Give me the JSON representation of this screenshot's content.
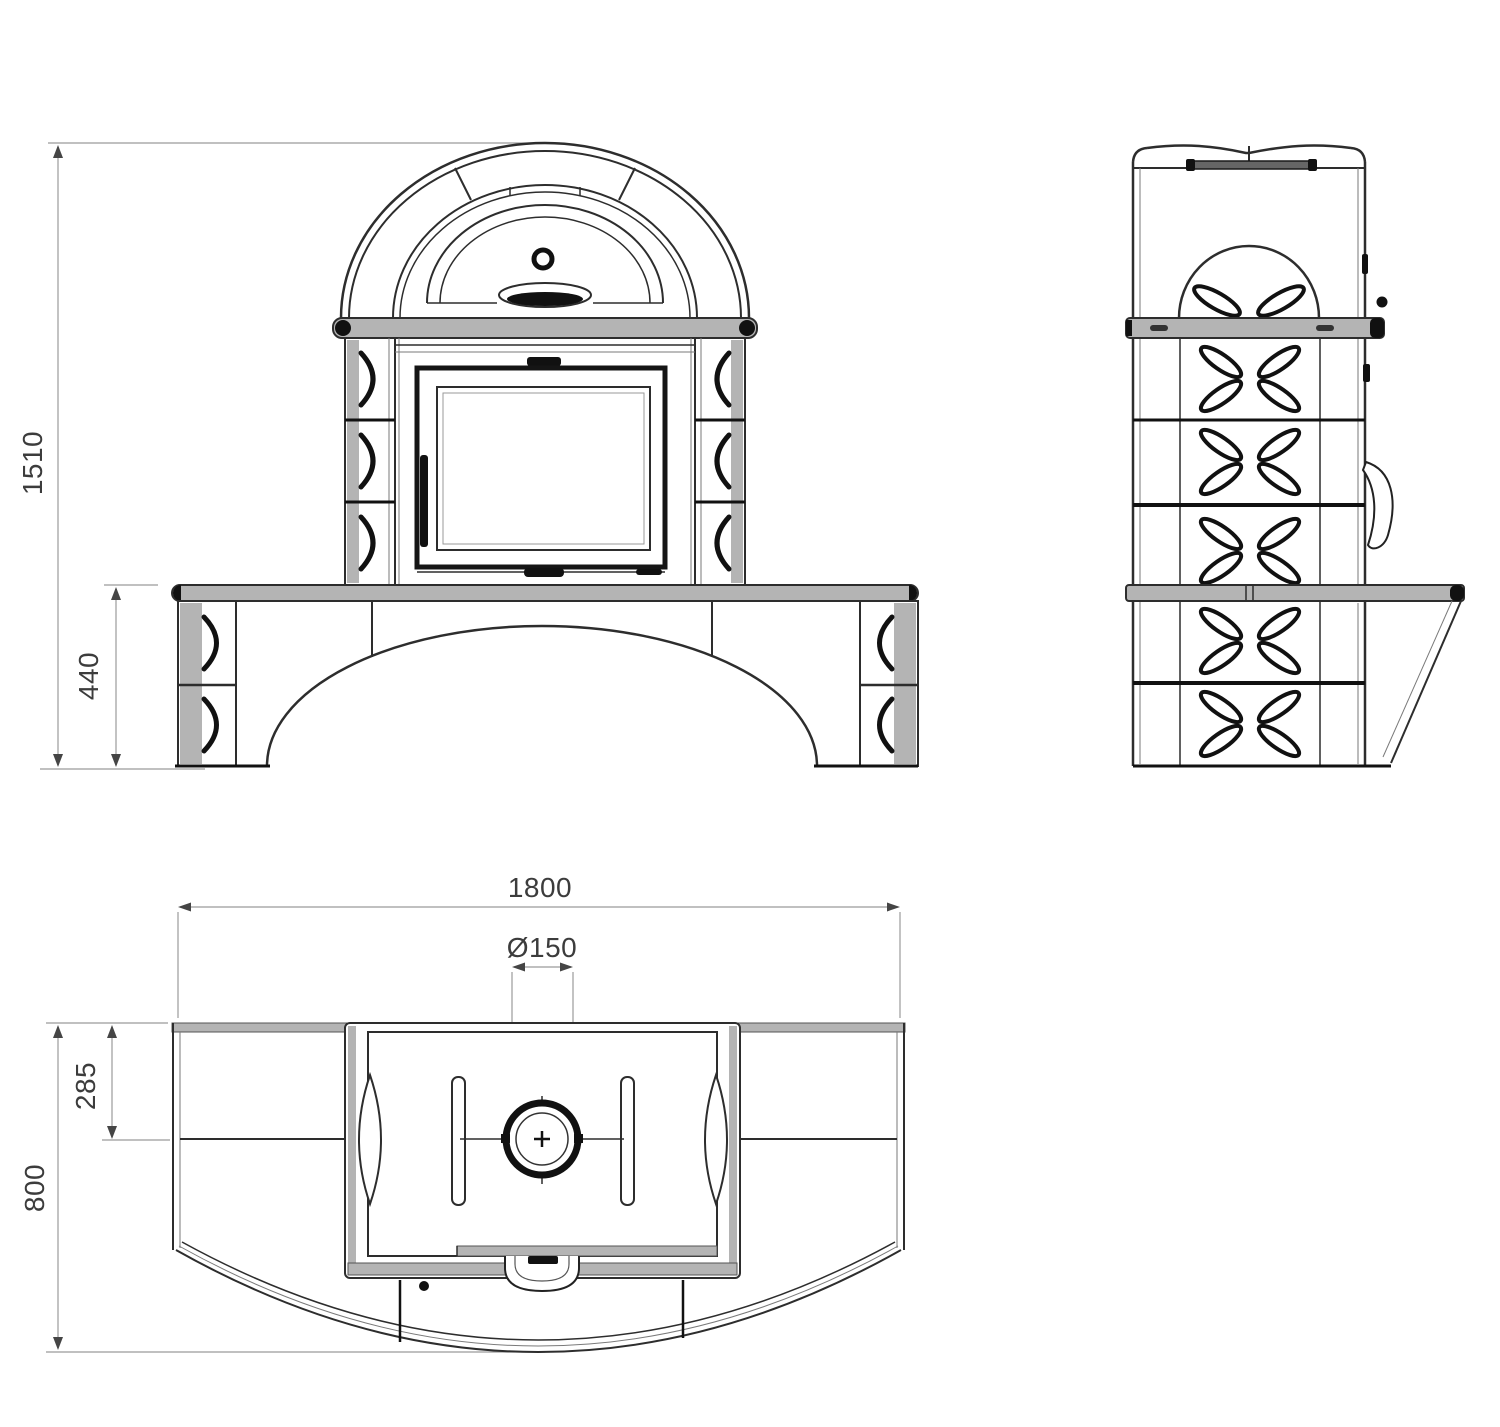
{
  "drawing": {
    "type": "technical-drawing-tiled-stove",
    "views": {
      "front": "front-elevation",
      "side": "side-elevation",
      "plan": "top-plan"
    },
    "dimensions": {
      "overall_height": "1510",
      "bench_height": "440",
      "overall_width": "1800",
      "flue_diameter": "Ø150",
      "top_depth": "285",
      "overall_depth": "800"
    },
    "colors": {
      "line": "#2d2d2d",
      "heavy": "#111111",
      "slab_fill": "#b4b4b4",
      "dimension_line": "#9b9b9b",
      "label_text": "#3c3c3c",
      "background": "#ffffff"
    }
  }
}
